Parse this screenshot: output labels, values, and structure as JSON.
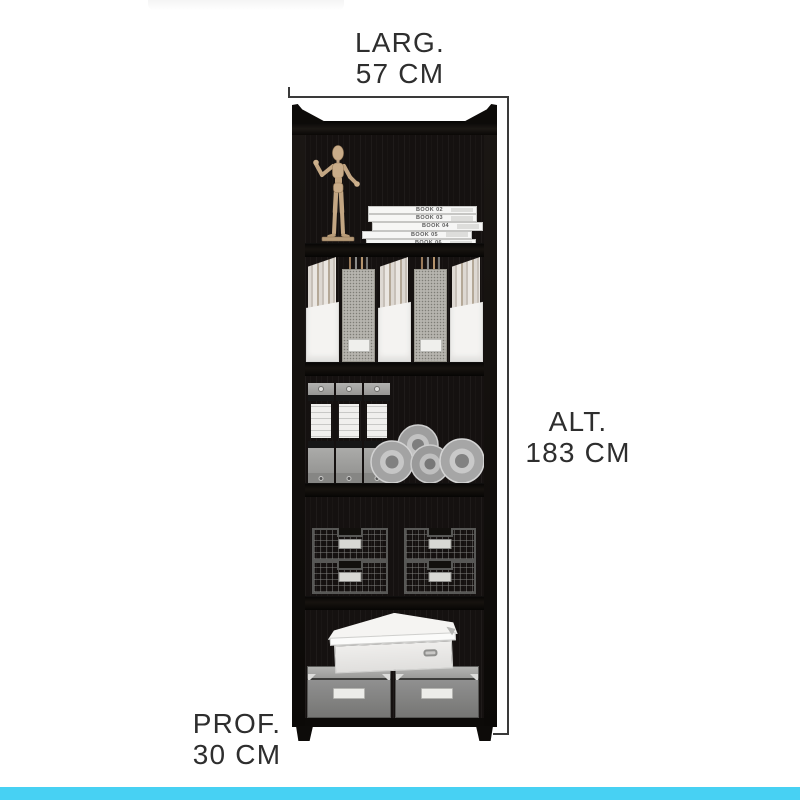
{
  "page": {
    "kind": "product-dimension-diagram",
    "background": "#ffffff",
    "accent_bar_color": "#47d1f3"
  },
  "dimensions": {
    "width": {
      "label": "LARG.",
      "value": "57 CM"
    },
    "height": {
      "label": "ALT.",
      "value": "183 CM"
    },
    "depth": {
      "label": "PROF.",
      "value": "30 CM"
    }
  },
  "bookshelf": {
    "frame_color": "#131110",
    "books": [
      {
        "title": "BOOK 02"
      },
      {
        "title": "BOOK 03"
      },
      {
        "title": "BOOK 04"
      },
      {
        "title": "BOOK 05"
      },
      {
        "title": "BOOK 06"
      }
    ],
    "shelves": [
      {
        "name": "shelf-1",
        "contents": [
          "wooden-mannequin",
          "stack-of-books"
        ]
      },
      {
        "name": "shelf-2",
        "contents": [
          "magazine-file-white",
          "magazine-file-gray",
          "magazine-file-white",
          "magazine-file-gray",
          "magazine-file-white"
        ]
      },
      {
        "name": "shelf-3",
        "contents": [
          "ring-binder",
          "ring-binder",
          "ring-binder",
          "tape-rolls"
        ]
      },
      {
        "name": "shelf-4",
        "contents": [
          "wire-basket-stack",
          "wire-basket-stack"
        ]
      },
      {
        "name": "shelf-5",
        "contents": [
          "white-lidded-box",
          "gray-storage-box",
          "gray-storage-box"
        ]
      }
    ]
  }
}
